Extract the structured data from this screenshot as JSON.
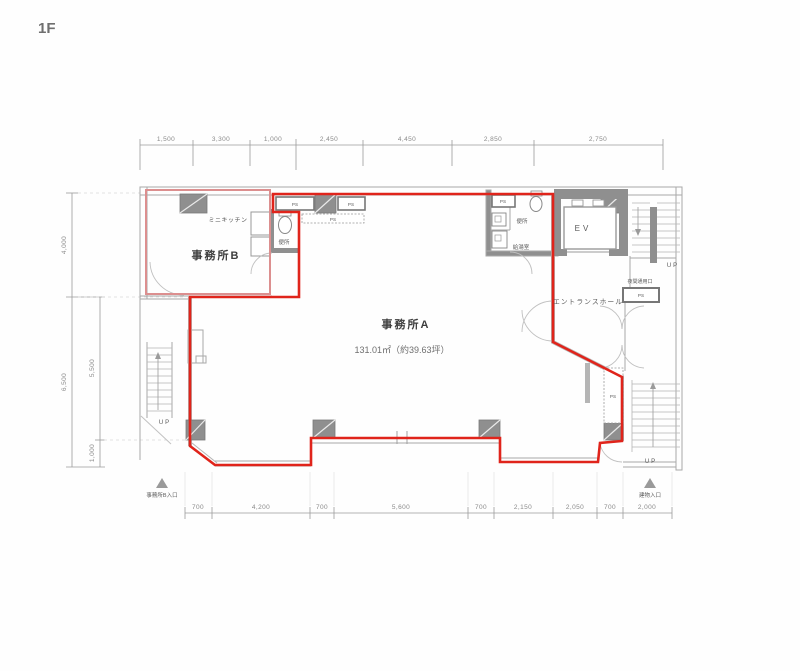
{
  "title": {
    "floor": "1F"
  },
  "rooms": {
    "office_a": {
      "name": "事務所A",
      "area": "131.01㎡（約39.63坪）"
    },
    "office_b": {
      "name": "事務所B"
    },
    "mini_kitchen": "ミニキッチン",
    "toilet_b": "便所",
    "toilet_a": "便所",
    "hot_water": "給湯室",
    "elevator": "EV",
    "entrance_hall": "エントランスホール",
    "night_door": "夜間通用口"
  },
  "labels": {
    "ps": "PS",
    "up": "UP"
  },
  "entrances": {
    "office_b": "事務所B入口",
    "building": "建物入口"
  },
  "dimensions": {
    "top": [
      "1,500",
      "3,300",
      "1,000",
      "2,450",
      "4,450",
      "2,850",
      "2,750"
    ],
    "left_outer": [
      "4,000",
      "6,500"
    ],
    "left_inner": [
      "5,500",
      "1,000"
    ],
    "bottom": [
      "700",
      "4,200",
      "700",
      "5,600",
      "700",
      "2,150",
      "2,050",
      "700",
      "2,000"
    ]
  },
  "colors": {
    "lease_outline": "#e0241b",
    "office_b_outline": "#dc8f8f",
    "area_text": "#d63a32"
  }
}
